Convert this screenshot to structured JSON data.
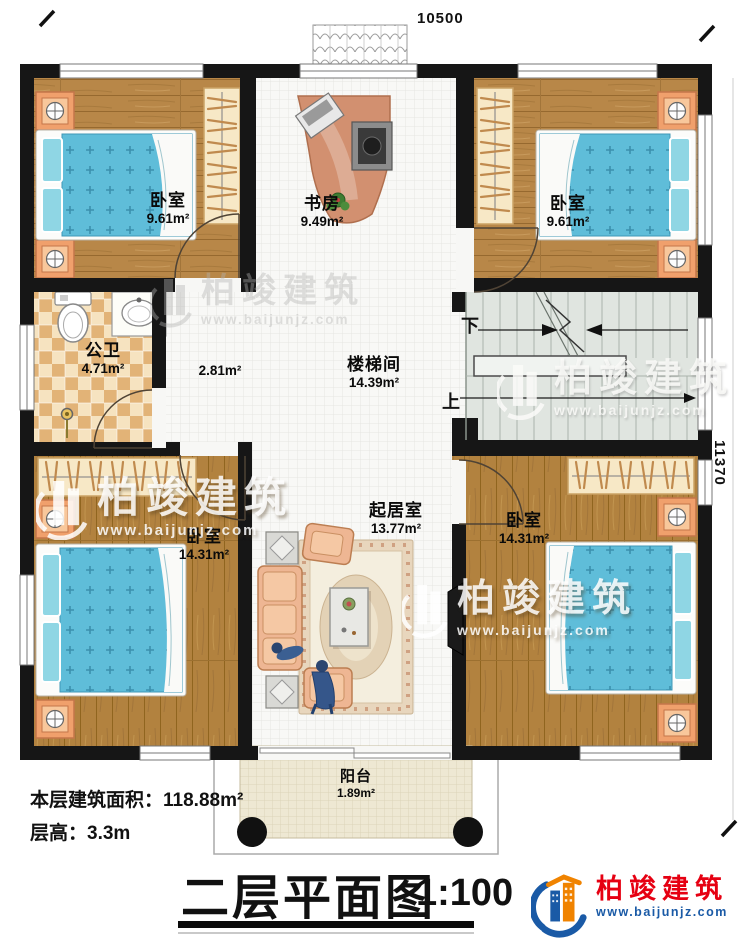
{
  "dimensions": {
    "top": "10500",
    "right": "11370"
  },
  "rooms": [
    {
      "name": "卧室",
      "area": "9.61m²"
    },
    {
      "name": "书房",
      "area": "9.49m²"
    },
    {
      "name": "卧室",
      "area": "9.61m²"
    },
    {
      "name": "公卫",
      "area": "4.71m²"
    },
    {
      "name": "",
      "area": "2.81m²"
    },
    {
      "name": "楼梯间",
      "area": "14.39m²"
    },
    {
      "name": "卧室",
      "area": "14.31m²"
    },
    {
      "name": "起居室",
      "area": "13.77m²"
    },
    {
      "name": "卧室",
      "area": "14.31m²"
    },
    {
      "name": "阳台",
      "area": "1.89m²"
    }
  ],
  "stairs": {
    "down_label": "下",
    "up_label": "上"
  },
  "title_block": {
    "area_label": "本层建筑面积：",
    "area_value": "118.88m²",
    "height_label": "层高：",
    "height_value": "3.3m",
    "plan_title": "二层平面图",
    "plan_scale": "1:100"
  },
  "watermark": {
    "brand": "柏竣建筑",
    "url": "www.baijunjz.com"
  },
  "logo": {
    "brand": "柏竣建筑",
    "url": "www.baijunjz.com"
  },
  "colors": {
    "wall": "#161616",
    "wood": "#b88748",
    "bed_quilt": "#5fbdd9",
    "bath_tile": "#e2b377",
    "brand_red": "#e60012",
    "brand_blue": "#1a5aa6",
    "brand_orange": "#f08300"
  }
}
